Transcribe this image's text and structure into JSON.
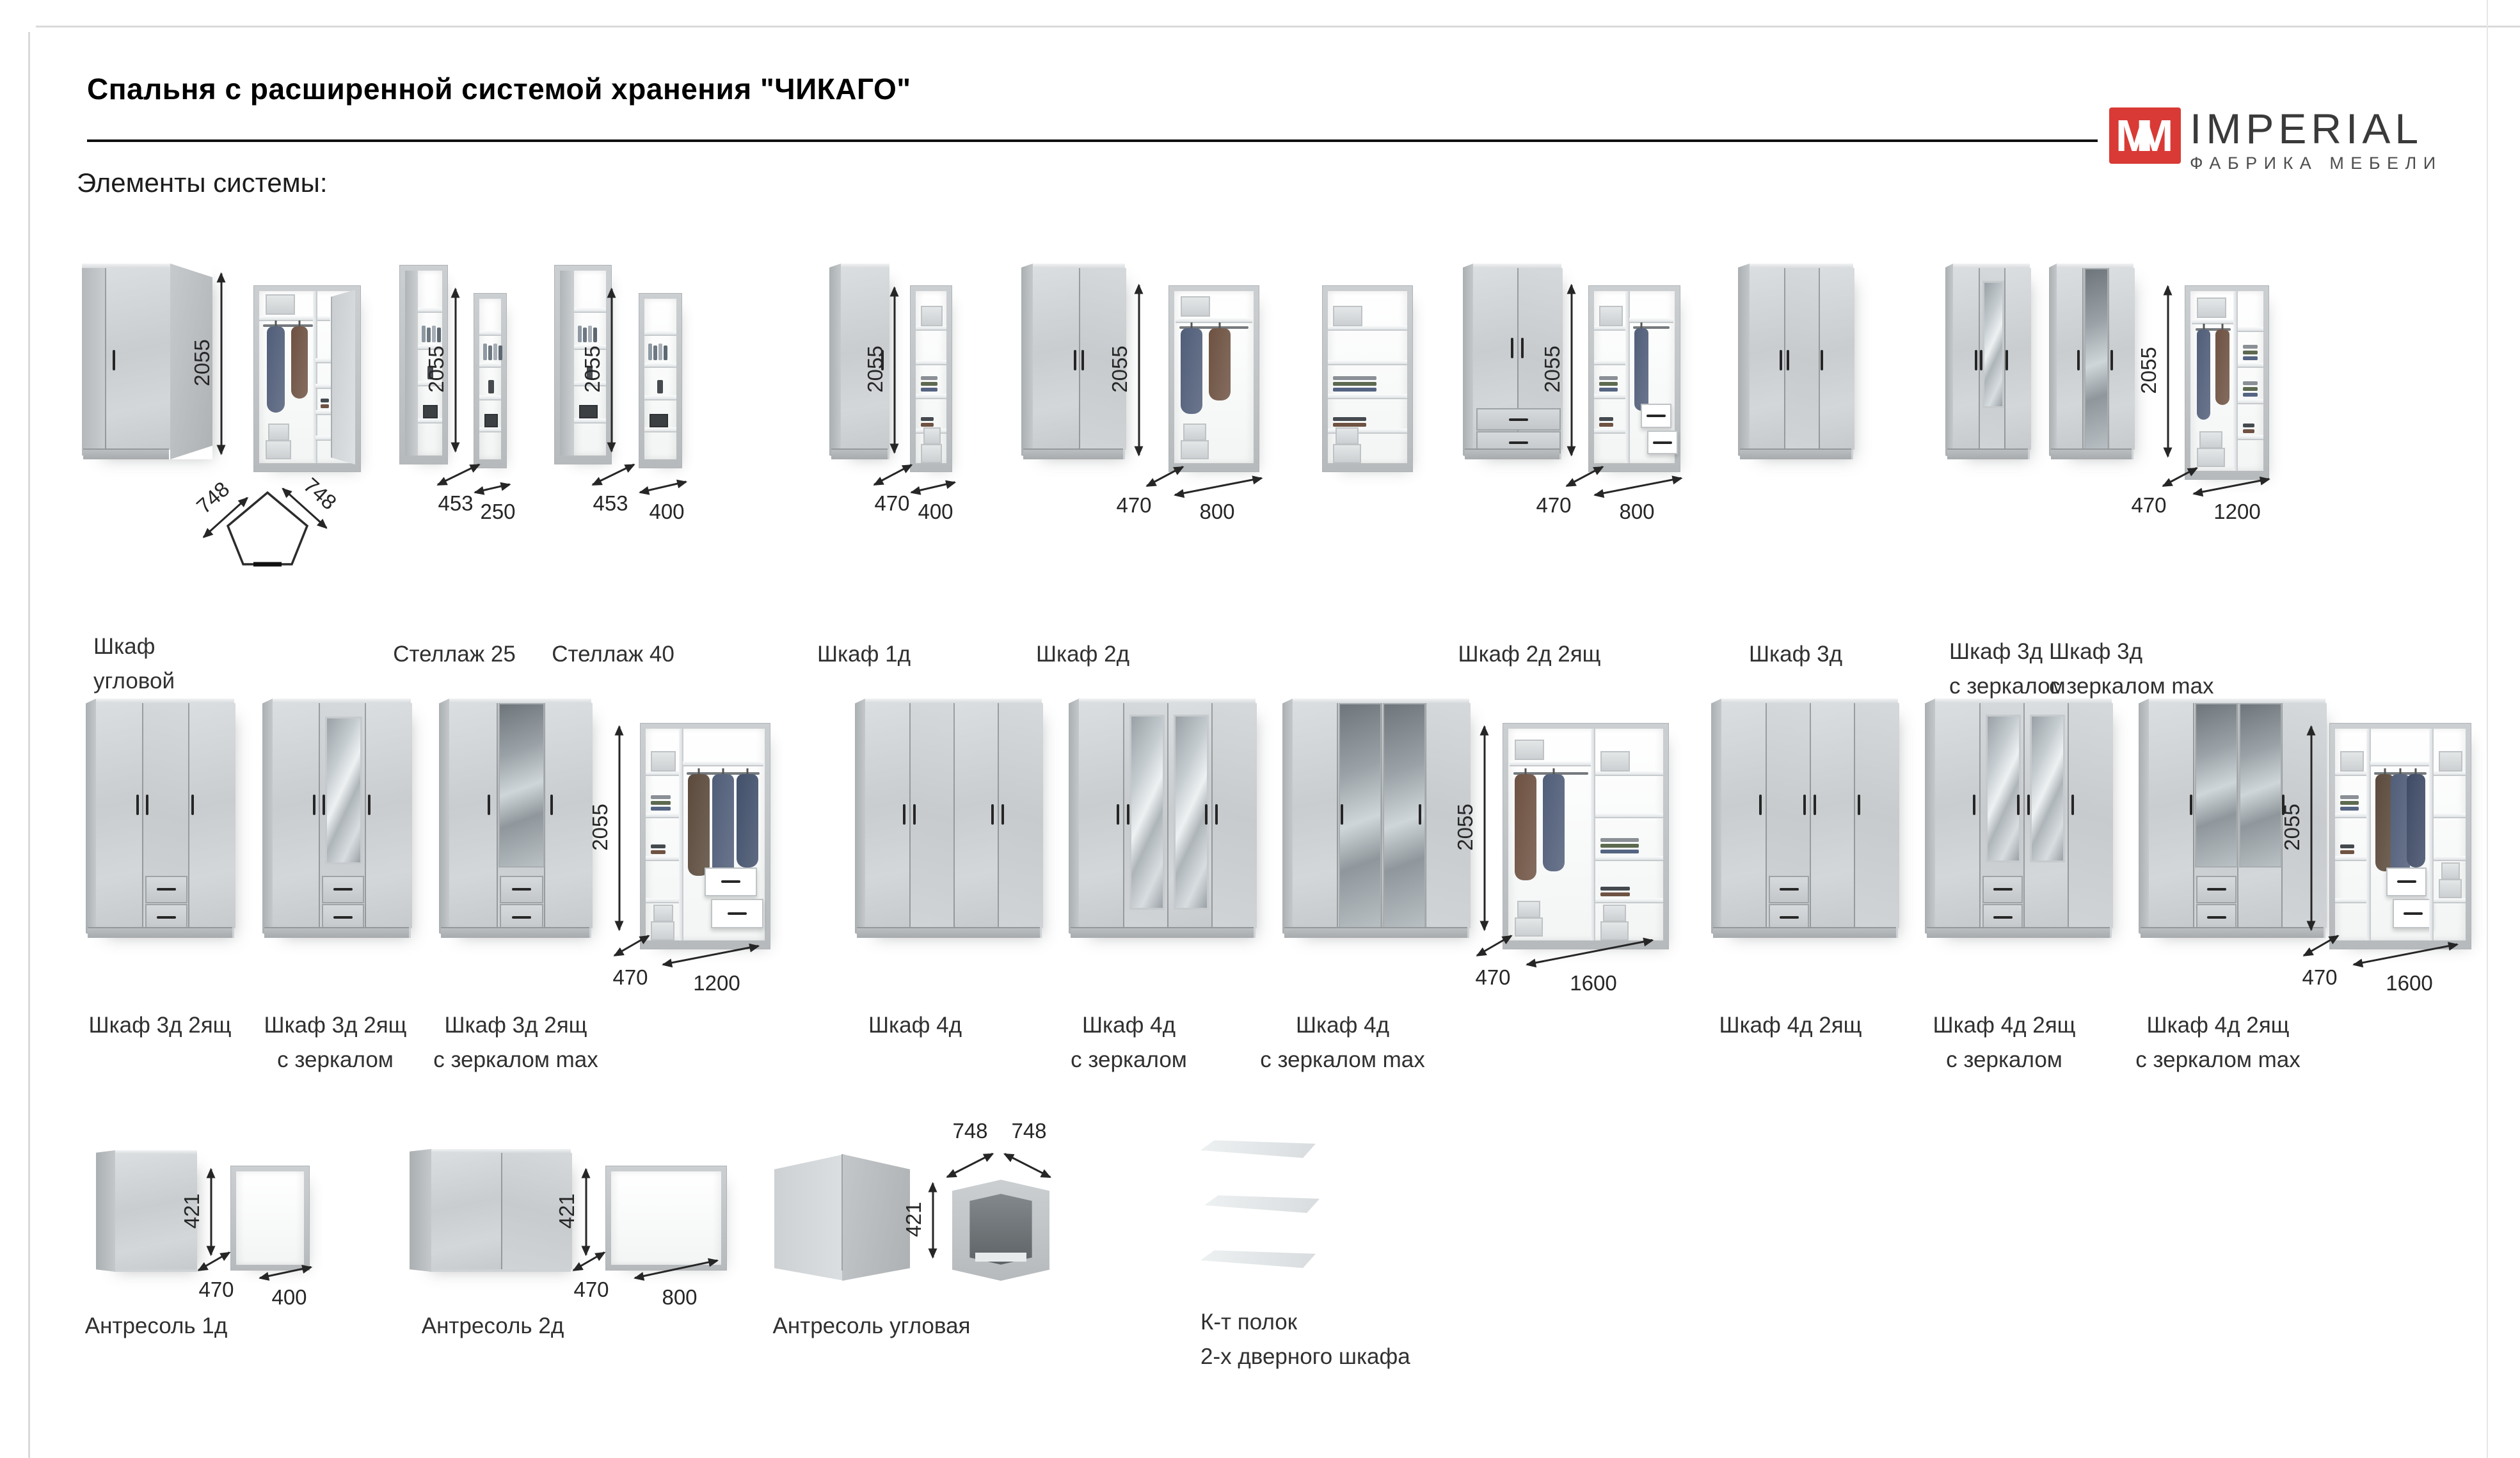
{
  "page": {
    "title": "Спальня с расширенной системой хранения \"ЧИКАГО\"",
    "section_heading": "Элементы системы:"
  },
  "logo": {
    "brand": "IMPERIAL",
    "tagline": "ФАБРИКА МЕБЕЛИ",
    "monogram": "M",
    "accent_color": "#d93a35"
  },
  "items": {
    "uglovoy": {
      "label_lines": [
        "Шкаф",
        "угловой"
      ],
      "height": "2055",
      "plan_depth": "748",
      "plan_width": "748"
    },
    "stellazh25": {
      "label_lines": [
        "Стеллаж 25"
      ],
      "height": "2055",
      "depth": "453",
      "width": "250"
    },
    "stellazh40": {
      "label_lines": [
        "Стеллаж 40"
      ],
      "height": "2055",
      "depth": "453",
      "width": "400"
    },
    "shkaf1d": {
      "label_lines": [
        "Шкаф 1д"
      ],
      "height": "2055",
      "depth": "470",
      "width": "400"
    },
    "shkaf2d": {
      "label_lines": [
        "Шкаф 2д"
      ],
      "height": "2055",
      "depth": "470",
      "width": "800"
    },
    "shkaf2d2y": {
      "label_lines": [
        "Шкаф 2д 2ящ"
      ],
      "height": "2055",
      "depth": "470",
      "width": "800"
    },
    "shkaf3d": {
      "label_lines": [
        "Шкаф 3д"
      ]
    },
    "shkaf3dz": {
      "label_lines": [
        "Шкаф 3д",
        "с зеркалом"
      ]
    },
    "shkaf3dzmax": {
      "label_lines": [
        "Шкаф 3д",
        "с зеркалом max"
      ],
      "height": "2055",
      "depth": "470",
      "width": "1200"
    },
    "shkaf3d2y": {
      "label_lines": [
        "Шкаф 3д 2ящ"
      ]
    },
    "shkaf3d2yz": {
      "label_lines": [
        "Шкаф 3д 2ящ",
        "с зеркалом"
      ]
    },
    "shkaf3d2yzmax": {
      "label_lines": [
        "Шкаф 3д 2ящ",
        "с зеркалом max"
      ],
      "height": "2055",
      "depth": "470",
      "width": "1200"
    },
    "shkaf4d": {
      "label_lines": [
        "Шкаф 4д"
      ]
    },
    "shkaf4dz": {
      "label_lines": [
        "Шкаф 4д",
        "с зеркалом"
      ]
    },
    "shkaf4dzmax": {
      "label_lines": [
        "Шкаф 4д",
        "с зеркалом max"
      ],
      "height": "2055",
      "depth": "470",
      "width": "1600"
    },
    "shkaf4d2y": {
      "label_lines": [
        "Шкаф 4д 2ящ"
      ]
    },
    "shkaf4d2yz": {
      "label_lines": [
        "Шкаф 4д 2ящ",
        "с зеркалом"
      ]
    },
    "shkaf4d2yzmax": {
      "label_lines": [
        "Шкаф 4д 2ящ",
        "с зеркалом max"
      ],
      "height": "2055",
      "depth": "470",
      "width": "1600"
    },
    "antresol1d": {
      "label_lines": [
        "Антресоль 1д"
      ],
      "height": "421",
      "depth": "470",
      "width": "400"
    },
    "antresol2d": {
      "label_lines": [
        "Антресоль 2д"
      ],
      "height": "421",
      "depth": "470",
      "width": "800"
    },
    "antresolugl": {
      "label_lines": [
        "Антресоль угловая"
      ],
      "height": "421",
      "plan_depth": "748",
      "plan_width": "748"
    },
    "ktpolok": {
      "label_lines": [
        "К-т полок",
        "2-х дверного шкафа"
      ]
    }
  }
}
